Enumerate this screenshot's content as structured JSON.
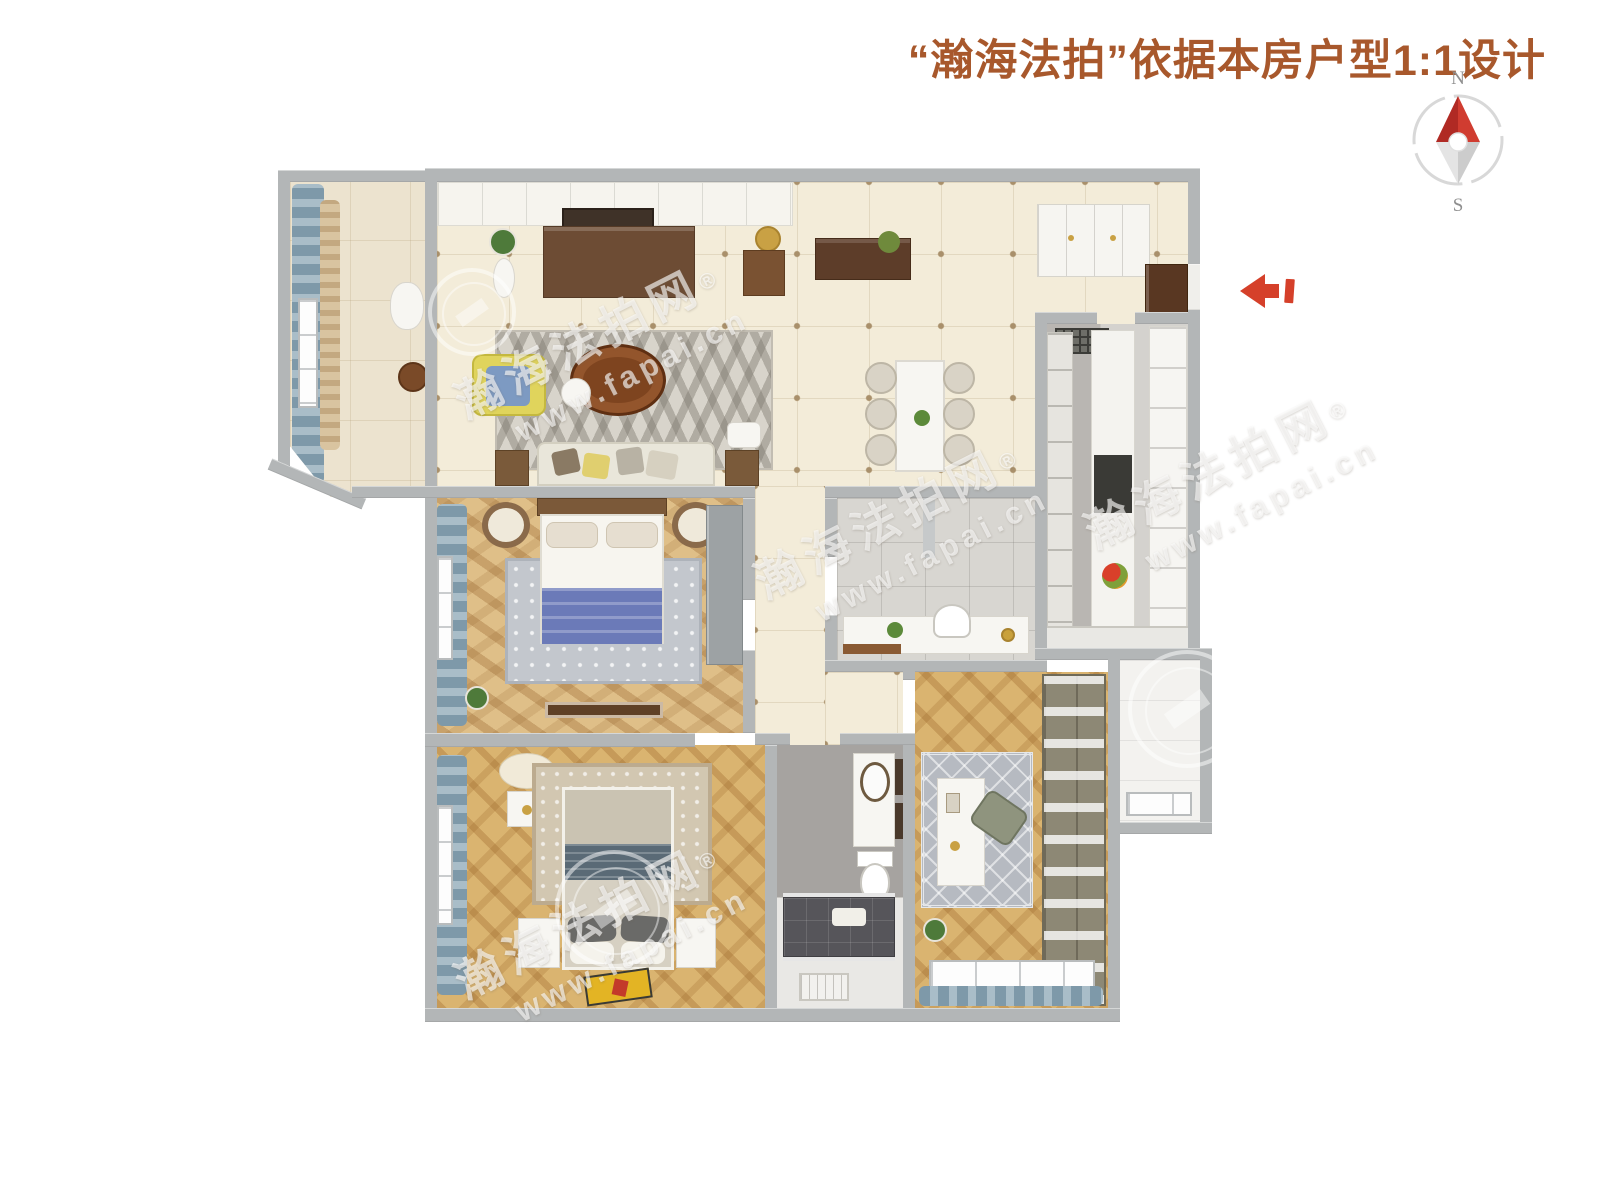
{
  "title": {
    "text": "“瀚海法拍”依据本房户型1:1设计",
    "color": "#a8582c"
  },
  "compass": {
    "north": "N",
    "south": "S",
    "colors": {
      "ring": "#d8d8d8",
      "needle_dark": "#b02a24",
      "needle_light": "#d03c30",
      "tail_light": "#e4e4e4",
      "tail_dark": "#cccccc",
      "hub": "#ffffff",
      "labels": "#8f8f8f"
    }
  },
  "entry_arrow": {
    "color": "#d5402a",
    "direction": "left"
  },
  "watermark": {
    "brand": "瀚海法拍网",
    "reg": "®",
    "url": "www.fapai.cn"
  },
  "palette": {
    "wall_gray": "#b3b6b7",
    "floor_tile_beige": "#f3ecd9",
    "floor_wood_gold": "#dab470",
    "curtain_blue": "#7e99a9",
    "accent_yellow": "#e0d45c",
    "bed_blanket_blue": "#6b7ab8",
    "coffee_table_brown": "#7e441f"
  }
}
